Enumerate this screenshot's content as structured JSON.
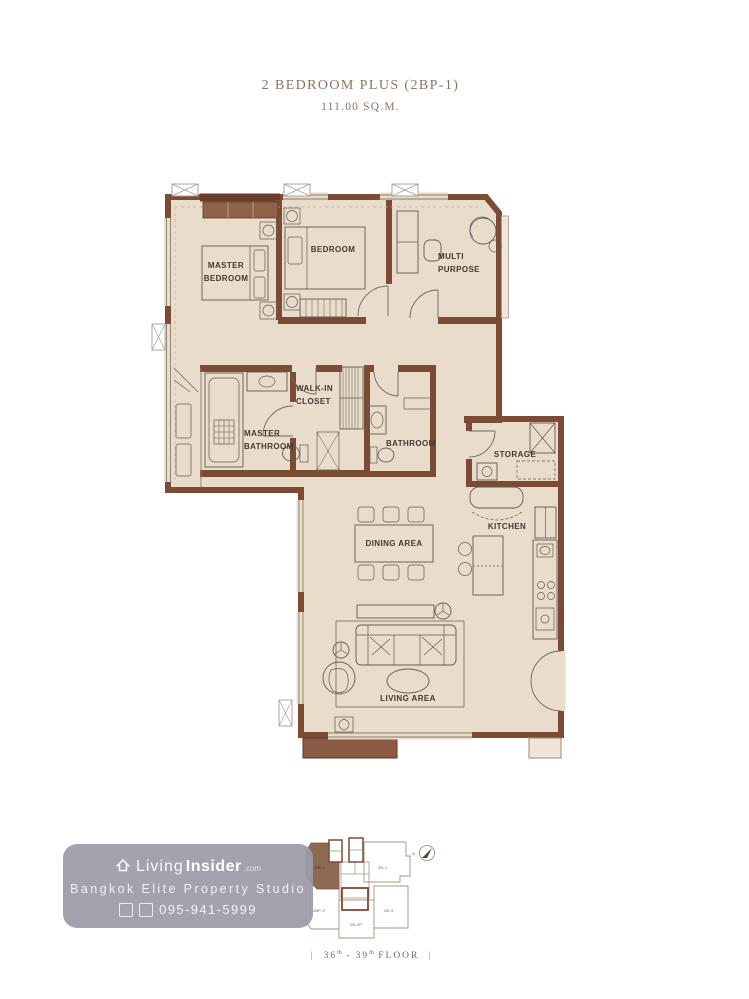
{
  "title": {
    "line1": "2 BEDROOM PLUS (2BP-1)",
    "line2": "111.00 SQ.M."
  },
  "plan": {
    "rooms": {
      "master_bedroom": [
        "MASTER",
        "BEDROOM"
      ],
      "bedroom": [
        "BEDROOM"
      ],
      "multi_purpose": [
        "MULTI",
        "PURPOSE"
      ],
      "walk_in_closet": [
        "WALK-IN",
        "CLOSET"
      ],
      "master_bathroom": [
        "MASTER",
        "BATHROOM"
      ],
      "bathroom": [
        "BATHROOM"
      ],
      "storage": [
        "STORAGE"
      ],
      "kitchen": [
        "KITCHEN"
      ],
      "dining_area": [
        "DINING AREA"
      ],
      "living_area": [
        "LIVING AREA"
      ]
    },
    "colors": {
      "wall": "#7b4b34",
      "wall_dark": "#6a3e2b",
      "floor": "#e9dcca",
      "balcony": "#8a5a42",
      "furniture_line": "#5f5b54",
      "label_text": "#3e3a35",
      "title_text": "#8c7262",
      "floor_note_text": "#6f6a63",
      "watermark_bg": "#9e9baa",
      "keyplan_highlight": "#8d6a52",
      "keyplan_outline": "#a89484"
    }
  },
  "keyplan": {
    "north": "N",
    "units": [
      {
        "label": "2BP-1",
        "highlighted": true
      },
      {
        "label": "2B-1",
        "highlighted": false
      },
      {
        "label": "2BP-2",
        "highlighted": false
      },
      {
        "label": "2B-2P",
        "highlighted": false
      },
      {
        "label": "2B-4",
        "highlighted": false
      }
    ]
  },
  "watermark": {
    "brand": {
      "prefix": "Living",
      "bold": "Insider",
      "suffix": ".com"
    },
    "studio": "Bangkok Elite Property Studio",
    "phone": "095-941-5999"
  },
  "floor_note": {
    "left_bar": "|",
    "start": "36",
    "start_sup": "th",
    "middle": "- 39",
    "middle_sup": "th",
    "end": "FLOOR",
    "right_bar": "|"
  }
}
